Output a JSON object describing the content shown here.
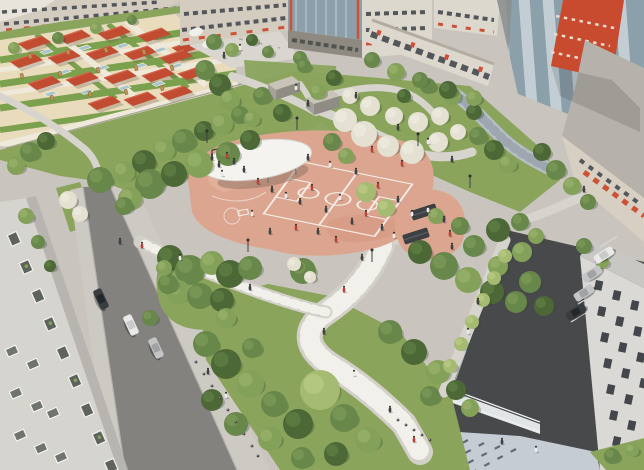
{
  "scene": {
    "description": "Aerial architectural rendering of a residential courtyard park with a terracotta sports playground under a white oval canopy, a kindergarten yard with red shade roofs, winding pedestrian paths, lawns, trees, roads with parked cars and surrounding apartment buildings",
    "palette": {
      "ground": "#c9c5be",
      "road1": "#84827f",
      "road2": "#47494b",
      "sidewalk": "#cdcac3",
      "curb": "#b5b2ac",
      "path": "#d7d4cd",
      "pathStripe": "#f2f0ea",
      "prom": "#d3d0c9",
      "lawn": "#8aa45c",
      "terracotta": "#dca58f",
      "terraLight": "#e8b9a3",
      "terraDeep": "#d2947e",
      "courtLine": "#f7f4ef",
      "canopy": "#f4f3ef",
      "canopyShadow": "#8b6f63",
      "seat": "#5b5e5c",
      "tree_shadow": "#33472c",
      "g1": "#4d6837",
      "g1_hi": "#688a49",
      "g2": "#68874a",
      "g2_hi": "#84a15c",
      "g3": "#84a15a",
      "g3_hi": "#a2b971",
      "g4": "#a6bb72",
      "g4_hi": "#c2d28c",
      "bl": "#e4e0d2",
      "bl_hi": "#f2efe6",
      "sand": "#e9dcbd",
      "yardGreen": "#7ca14e",
      "yardPath": "#efe9da",
      "roofRed": "#c14c32",
      "roofRedLight": "#d4654a",
      "sandbox": "#a7c6cb",
      "wood": "#bd9357",
      "bldgBeige": "#d3ccbf",
      "bldgLight": "#ddd8cd",
      "windowDark": "#53565a",
      "accent": "#cd5136",
      "towerRed": "#c84b2f",
      "glassLight": "#c2ced4",
      "glassDark": "#8ca0ab",
      "b7wall": "#dbd9d5",
      "b7roof": "#c9c7c3",
      "b7window": "#43464a",
      "b1wall": "#d6d4cf",
      "plaza": "#c6ccd4",
      "plazaDash": "#4c525a",
      "fence": "#eef0f0",
      "carWhite": "#e9e9e7",
      "carWhite_cab": "#c9cbc9",
      "carSilver": "#c3c5c7",
      "carSilver_cab": "#9fa3a5",
      "carDark": "#3a3d40",
      "carDark_cab": "#23262a",
      "bollard": "#45474a",
      "pd": "#3f4245",
      "pr": "#b5443a",
      "pw": "#eceae6",
      "head": "#2e2b28",
      "table": "#3c4043",
      "kiosk_top": "#c9c4b8",
      "kiosk_front": "#8f8c84",
      "kiosk_side": "#a5a29a"
    },
    "counts": {
      "cars_street": 3,
      "cars_parking": 4,
      "kindergarten_roofs": 18
    },
    "trees": [
      [
        100,
        180,
        13,
        "g2"
      ],
      [
        124,
        172,
        11,
        "g3"
      ],
      [
        144,
        162,
        12,
        "g1"
      ],
      [
        164,
        150,
        11,
        "g3"
      ],
      [
        184,
        141,
        12,
        "g2"
      ],
      [
        204,
        131,
        10,
        "g1"
      ],
      [
        222,
        124,
        11,
        "g3"
      ],
      [
        150,
        184,
        15,
        "g2"
      ],
      [
        174,
        174,
        13,
        "g1"
      ],
      [
        199,
        164,
        14,
        "g3"
      ],
      [
        228,
        154,
        12,
        "g2"
      ],
      [
        250,
        140,
        10,
        "g1"
      ],
      [
        130,
        199,
        12,
        "g3"
      ],
      [
        124,
        206,
        9,
        "g2"
      ],
      [
        68,
        200,
        9,
        "bl"
      ],
      [
        80,
        214,
        8,
        "bl"
      ],
      [
        30,
        152,
        10,
        "g2"
      ],
      [
        16,
        166,
        9,
        "g3"
      ],
      [
        46,
        141,
        9,
        "g1"
      ],
      [
        205,
        70,
        10,
        "g2"
      ],
      [
        220,
        85,
        11,
        "g1"
      ],
      [
        230,
        100,
        10,
        "g3"
      ],
      [
        240,
        115,
        9,
        "g2"
      ],
      [
        58,
        38,
        6,
        "g2"
      ],
      [
        96,
        28,
        6,
        "g3"
      ],
      [
        132,
        20,
        5,
        "g2"
      ],
      [
        14,
        48,
        6,
        "g3"
      ],
      [
        214,
        42,
        8,
        "g2"
      ],
      [
        232,
        50,
        7,
        "g3"
      ],
      [
        252,
        40,
        6,
        "g1"
      ],
      [
        300,
        58,
        7,
        "g2"
      ],
      [
        268,
        52,
        6,
        "g2"
      ],
      [
        262,
        96,
        9,
        "g2"
      ],
      [
        318,
        92,
        8,
        "g3"
      ],
      [
        282,
        113,
        9,
        "g1"
      ],
      [
        252,
        119,
        8,
        "g3"
      ],
      [
        304,
        66,
        7,
        "g2"
      ],
      [
        334,
        78,
        8,
        "g1"
      ],
      [
        345,
        120,
        12,
        "bl"
      ],
      [
        364,
        134,
        13,
        "bl"
      ],
      [
        388,
        146,
        11,
        "bl"
      ],
      [
        412,
        152,
        12,
        "bl"
      ],
      [
        438,
        142,
        10,
        "bl"
      ],
      [
        370,
        106,
        10,
        "bl"
      ],
      [
        394,
        116,
        9,
        "bl"
      ],
      [
        418,
        122,
        10,
        "bl"
      ],
      [
        350,
        96,
        8,
        "bl"
      ],
      [
        440,
        116,
        9,
        "bl"
      ],
      [
        458,
        132,
        8,
        "bl"
      ],
      [
        332,
        142,
        9,
        "g2"
      ],
      [
        404,
        96,
        7,
        "g1"
      ],
      [
        428,
        86,
        8,
        "g2"
      ],
      [
        452,
        96,
        9,
        "g3"
      ],
      [
        474,
        112,
        8,
        "g1"
      ],
      [
        346,
        156,
        8,
        "g3"
      ],
      [
        478,
        136,
        9,
        "g2"
      ],
      [
        494,
        150,
        10,
        "g1"
      ],
      [
        508,
        164,
        9,
        "g3"
      ],
      [
        303,
        271,
        13,
        "g2"
      ],
      [
        294,
        264,
        7,
        "bl"
      ],
      [
        310,
        277,
        6,
        "bl"
      ],
      [
        170,
        258,
        13,
        "g1"
      ],
      [
        190,
        270,
        15,
        "g2"
      ],
      [
        212,
        263,
        12,
        "g3"
      ],
      [
        230,
        274,
        14,
        "g1"
      ],
      [
        250,
        268,
        12,
        "g2"
      ],
      [
        178,
        292,
        12,
        "g3"
      ],
      [
        200,
        296,
        13,
        "g2"
      ],
      [
        222,
        300,
        12,
        "g1"
      ],
      [
        168,
        284,
        10,
        "g2"
      ],
      [
        164,
        268,
        8,
        "g3"
      ],
      [
        150,
        318,
        8,
        "g2"
      ],
      [
        226,
        318,
        10,
        "g3"
      ],
      [
        206,
        344,
        13,
        "g2"
      ],
      [
        226,
        364,
        15,
        "g1"
      ],
      [
        250,
        384,
        14,
        "g3"
      ],
      [
        274,
        404,
        13,
        "g2"
      ],
      [
        298,
        424,
        15,
        "g1"
      ],
      [
        270,
        439,
        12,
        "g3"
      ],
      [
        236,
        424,
        12,
        "g2"
      ],
      [
        212,
        400,
        11,
        "g1"
      ],
      [
        320,
        390,
        20,
        "g4"
      ],
      [
        344,
        418,
        14,
        "g2"
      ],
      [
        368,
        440,
        13,
        "g3"
      ],
      [
        336,
        454,
        12,
        "g1"
      ],
      [
        302,
        458,
        11,
        "g2"
      ],
      [
        252,
        348,
        10,
        "g2"
      ],
      [
        390,
        332,
        12,
        "g2"
      ],
      [
        414,
        352,
        13,
        "g1"
      ],
      [
        438,
        372,
        12,
        "g3"
      ],
      [
        430,
        396,
        10,
        "g2"
      ],
      [
        456,
        390,
        10,
        "g1"
      ],
      [
        470,
        408,
        9,
        "g3"
      ],
      [
        420,
        252,
        12,
        "g1"
      ],
      [
        444,
        266,
        14,
        "g2"
      ],
      [
        468,
        280,
        13,
        "g3"
      ],
      [
        492,
        292,
        12,
        "g1"
      ],
      [
        516,
        302,
        11,
        "g2"
      ],
      [
        498,
        266,
        10,
        "g3"
      ],
      [
        474,
        246,
        11,
        "g2"
      ],
      [
        498,
        230,
        12,
        "g1"
      ],
      [
        522,
        252,
        10,
        "g3"
      ],
      [
        530,
        282,
        11,
        "g2"
      ],
      [
        544,
        306,
        10,
        "g1"
      ],
      [
        460,
        226,
        9,
        "g2"
      ],
      [
        436,
        216,
        8,
        "g3"
      ],
      [
        366,
        192,
        10,
        "g4"
      ],
      [
        386,
        208,
        9,
        "g4"
      ],
      [
        372,
        60,
        8,
        "g2"
      ],
      [
        396,
        72,
        9,
        "g3"
      ],
      [
        420,
        80,
        8,
        "g2"
      ],
      [
        448,
        90,
        9,
        "g1"
      ],
      [
        474,
        98,
        8,
        "g3"
      ],
      [
        542,
        152,
        9,
        "g1"
      ],
      [
        556,
        170,
        10,
        "g2"
      ],
      [
        572,
        186,
        9,
        "g3"
      ],
      [
        588,
        202,
        8,
        "g2"
      ],
      [
        584,
        246,
        8,
        "g2"
      ],
      [
        602,
        262,
        7,
        "g3"
      ],
      [
        505,
        256,
        7,
        "g4"
      ],
      [
        494,
        278,
        7,
        "g4"
      ],
      [
        483,
        300,
        7,
        "g4"
      ],
      [
        472,
        322,
        7,
        "g4"
      ],
      [
        461,
        344,
        7,
        "g4"
      ],
      [
        450,
        366,
        7,
        "g4"
      ],
      [
        612,
        456,
        8,
        "g2"
      ],
      [
        632,
        450,
        7,
        "g3"
      ],
      [
        26,
        216,
        8,
        "g3"
      ],
      [
        38,
        242,
        7,
        "g2"
      ],
      [
        50,
        266,
        6,
        "g1"
      ],
      [
        520,
        222,
        9,
        "g2"
      ],
      [
        536,
        236,
        8,
        "g3"
      ]
    ],
    "people": [
      [
        212,
        158,
        "pd"
      ],
      [
        219,
        165,
        "pd"
      ],
      [
        227,
        156,
        "pr"
      ],
      [
        234,
        162,
        "pd"
      ],
      [
        222,
        174,
        "pw"
      ],
      [
        244,
        170,
        "pd"
      ],
      [
        258,
        182,
        "pr"
      ],
      [
        272,
        190,
        "pd"
      ],
      [
        286,
        196,
        "pw"
      ],
      [
        300,
        202,
        "pd"
      ],
      [
        312,
        188,
        "pr"
      ],
      [
        326,
        210,
        "pd"
      ],
      [
        340,
        198,
        "pw"
      ],
      [
        352,
        222,
        "pd"
      ],
      [
        366,
        214,
        "pr"
      ],
      [
        382,
        228,
        "pd"
      ],
      [
        394,
        236,
        "pw"
      ],
      [
        296,
        228,
        "pr"
      ],
      [
        270,
        232,
        "pd"
      ],
      [
        252,
        214,
        "pw"
      ],
      [
        318,
        232,
        "pd"
      ],
      [
        336,
        240,
        "pr"
      ],
      [
        308,
        158,
        "pd"
      ],
      [
        330,
        165,
        "pw"
      ],
      [
        356,
        172,
        "pd"
      ],
      [
        378,
        186,
        "pr"
      ],
      [
        398,
        200,
        "pd"
      ],
      [
        412,
        214,
        "pw"
      ],
      [
        402,
        164,
        "pr"
      ],
      [
        444,
        220,
        "pd"
      ],
      [
        450,
        234,
        "pr"
      ],
      [
        452,
        247,
        "pd"
      ],
      [
        428,
        210,
        "pw"
      ],
      [
        362,
        258,
        "pd"
      ],
      [
        344,
        290,
        "pr"
      ],
      [
        324,
        332,
        "pd"
      ],
      [
        354,
        374,
        "pw"
      ],
      [
        390,
        410,
        "pd"
      ],
      [
        414,
        440,
        "pr"
      ],
      [
        250,
        288,
        "pd"
      ],
      [
        180,
        258,
        "pw"
      ],
      [
        120,
        242,
        "pd"
      ],
      [
        142,
        246,
        "pr"
      ],
      [
        398,
        128,
        "pd"
      ],
      [
        428,
        142,
        "pw"
      ],
      [
        372,
        150,
        "pr"
      ],
      [
        356,
        96,
        "pd"
      ],
      [
        452,
        160,
        "pd"
      ],
      [
        308,
        104,
        "pd"
      ],
      [
        296,
        88,
        "pw"
      ],
      [
        478,
        302,
        "pd"
      ],
      [
        468,
        332,
        "pw"
      ],
      [
        584,
        190,
        "pd"
      ],
      [
        208,
        372,
        "pd"
      ],
      [
        226,
        396,
        "pw"
      ],
      [
        502,
        442,
        "pd"
      ],
      [
        536,
        450,
        "pw"
      ],
      [
        224,
        56,
        "pd"
      ],
      [
        240,
        48,
        "pw"
      ]
    ],
    "kindergarten": {
      "roofs": [
        [
          18,
          44
        ],
        [
          58,
          38
        ],
        [
          98,
          34
        ],
        [
          138,
          36
        ],
        [
          172,
          48
        ],
        [
          10,
          62
        ],
        [
          48,
          58
        ],
        [
          86,
          54
        ],
        [
          124,
          54
        ],
        [
          160,
          58
        ],
        [
          28,
          84
        ],
        [
          66,
          80
        ],
        [
          104,
          78
        ],
        [
          142,
          76
        ],
        [
          178,
          74
        ],
        [
          88,
          104
        ],
        [
          124,
          100
        ],
        [
          160,
          94
        ]
      ],
      "sandboxes": [
        [
          40,
          52
        ],
        [
          78,
          48
        ],
        [
          116,
          46
        ],
        [
          154,
          50
        ],
        [
          58,
          72
        ],
        [
          96,
          68
        ],
        [
          134,
          66
        ],
        [
          170,
          66
        ],
        [
          80,
          92
        ],
        [
          118,
          88
        ],
        [
          152,
          84
        ],
        [
          44,
          94
        ]
      ],
      "play_structures": [
        [
          30,
          56
        ],
        [
          68,
          52
        ],
        [
          106,
          50
        ],
        [
          144,
          52
        ],
        [
          22,
          76
        ],
        [
          60,
          74
        ],
        [
          98,
          70
        ],
        [
          136,
          68
        ],
        [
          172,
          68
        ],
        [
          52,
          98
        ],
        [
          90,
          94
        ],
        [
          126,
          92
        ],
        [
          162,
          88
        ]
      ]
    },
    "cars": [
      [
        101,
        299,
        65,
        "carDark"
      ],
      [
        131,
        325,
        65,
        "carWhite"
      ],
      [
        156,
        348,
        65,
        "carSilver"
      ],
      [
        604,
        255,
        -32,
        "carWhite"
      ],
      [
        592,
        274,
        -32,
        "carSilver"
      ],
      [
        584,
        293,
        -32,
        "carSilver"
      ],
      [
        576,
        312,
        -32,
        "carDark"
      ]
    ],
    "parking_lines": [
      [
        600,
        247
      ],
      [
        592,
        266
      ],
      [
        585,
        285
      ],
      [
        578,
        304
      ],
      [
        571,
        322
      ]
    ],
    "bollards": [
      [
        196,
        362
      ],
      [
        204,
        374
      ],
      [
        212,
        386
      ],
      [
        220,
        398
      ],
      [
        228,
        410
      ],
      [
        236,
        422
      ],
      [
        244,
        434
      ],
      [
        252,
        446
      ],
      [
        258,
        456
      ],
      [
        398,
        420
      ],
      [
        406,
        425
      ],
      [
        414,
        430
      ],
      [
        422,
        435
      ],
      [
        430,
        440
      ]
    ],
    "lights": [
      [
        207,
        143
      ],
      [
        297,
        130
      ],
      [
        418,
        146
      ],
      [
        470,
        188
      ],
      [
        372,
        262
      ],
      [
        248,
        252
      ]
    ],
    "balconies": [
      [
        16,
        232
      ],
      [
        28,
        260
      ],
      [
        40,
        289
      ],
      [
        52,
        317
      ],
      [
        65,
        346
      ],
      [
        77,
        374
      ],
      [
        89,
        403
      ],
      [
        101,
        431
      ],
      [
        113,
        459
      ]
    ],
    "b1_windows": [
      [
        6,
        350
      ],
      [
        27,
        363
      ],
      [
        10,
        392
      ],
      [
        31,
        405
      ],
      [
        14,
        434
      ],
      [
        35,
        447
      ],
      [
        55,
        456
      ],
      [
        47,
        412
      ]
    ],
    "b7_windows": [
      [
        596,
        280
      ],
      [
        599,
        306
      ],
      [
        602,
        332
      ],
      [
        605,
        358
      ],
      [
        608,
        384
      ],
      [
        611,
        410
      ],
      [
        614,
        436
      ],
      [
        614,
        290
      ],
      [
        617,
        316
      ],
      [
        620,
        342
      ],
      [
        623,
        368
      ],
      [
        626,
        394
      ],
      [
        629,
        420
      ],
      [
        632,
        300
      ],
      [
        635,
        326
      ],
      [
        638,
        352
      ],
      [
        641,
        378
      ]
    ]
  }
}
